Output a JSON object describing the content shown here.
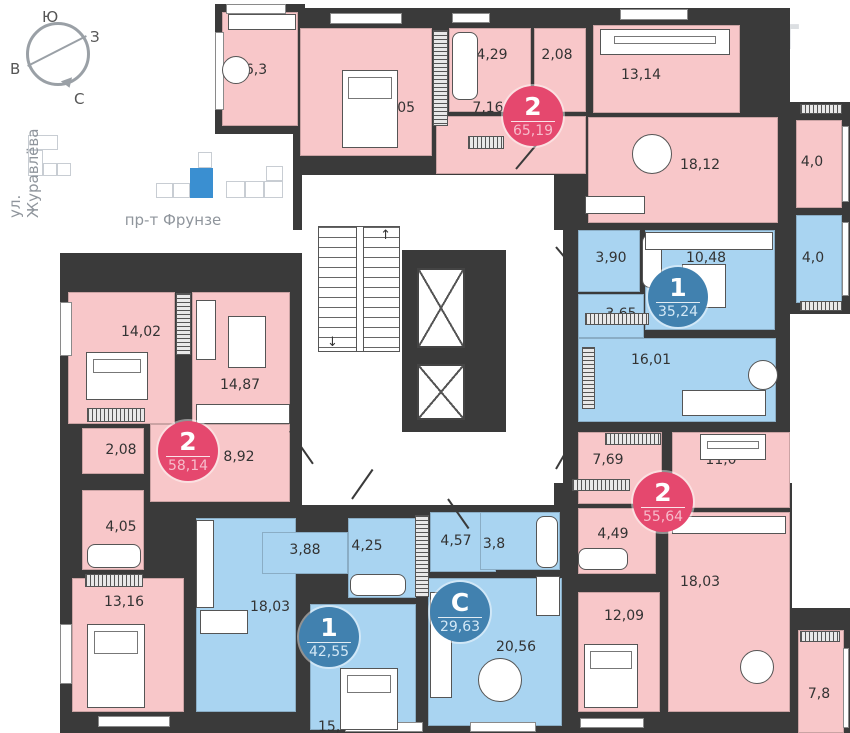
{
  "colors": {
    "wall": "#3a3a3a",
    "room_pink": "#f8c7c9",
    "room_blue": "#a9d4f1",
    "badge_red": "#e5486e",
    "badge_blue": "#4181af",
    "minimap_highlight": "#3a8fd1"
  },
  "compass": {
    "labels": [
      {
        "t": "Ю",
        "x": 42,
        "y": 8
      },
      {
        "t": "З",
        "x": 90,
        "y": 28
      },
      {
        "t": "В",
        "x": 10,
        "y": 60
      },
      {
        "t": "С",
        "x": 74,
        "y": 90
      }
    ]
  },
  "minimap": {
    "street_left": "ул. Журавлёва",
    "street_bottom": "пр-т Фрунзе",
    "origin": [
      20,
      130
    ],
    "blocks": [
      {
        "r": [
          8,
          5,
          30,
          15
        ]
      },
      {
        "r": [
          8,
          20,
          15,
          26
        ]
      },
      {
        "r": [
          23,
          33,
          14,
          13
        ]
      },
      {
        "r": [
          37,
          33,
          14,
          13
        ]
      },
      {
        "r": [
          136,
          53,
          17,
          15
        ]
      },
      {
        "r": [
          153,
          53,
          17,
          15
        ]
      },
      {
        "r": [
          170,
          38,
          23,
          30
        ],
        "hl": true
      },
      {
        "r": [
          178,
          22,
          14,
          16
        ]
      },
      {
        "r": [
          206,
          51,
          19,
          17
        ]
      },
      {
        "r": [
          225,
          51,
          19,
          17
        ]
      },
      {
        "r": [
          244,
          51,
          19,
          17
        ]
      },
      {
        "r": [
          246,
          36,
          17,
          15
        ]
      }
    ]
  },
  "watermark": {
    "line1": "ОНРЕАЛТ",
    "line2": "НЕДВИЖИМОСТЬ"
  },
  "plan": {
    "zones": [
      [
        215,
        4,
        90,
        130
      ],
      [
        293,
        8,
        497,
        222
      ],
      [
        788,
        102,
        62,
        212
      ],
      [
        563,
        222,
        227,
        273
      ],
      [
        60,
        253,
        245,
        480
      ],
      [
        178,
        483,
        614,
        250
      ],
      [
        790,
        608,
        60,
        125
      ]
    ],
    "corridor": {
      "rect": [
        302,
        175,
        252,
        330
      ],
      "stairs": [
        318,
        226,
        82,
        126
      ],
      "lift_block": [
        402,
        250,
        104,
        182
      ],
      "lifts": [
        [
          417,
          268,
          48,
          80
        ],
        [
          417,
          364,
          48,
          56
        ]
      ],
      "arrow_up": "↑",
      "arrow_down": "↓"
    },
    "extra_walls": [
      [
        295,
        560,
        16,
        152
      ],
      [
        416,
        578,
        16,
        152
      ]
    ],
    "rooms": [
      {
        "id": "balcony-6-3",
        "label": "6,3",
        "r": [
          222,
          12,
          76,
          114
        ],
        "c": "pink",
        "l": [
          256,
          70
        ]
      },
      {
        "id": "bedroom-16-05",
        "label": "16,05",
        "r": [
          300,
          28,
          132,
          128
        ],
        "c": "pink",
        "l": [
          395,
          108
        ]
      },
      {
        "id": "bath-4-29",
        "label": "4,29",
        "r": [
          449,
          28,
          82,
          84
        ],
        "c": "pink",
        "l": [
          492,
          55
        ]
      },
      {
        "id": "wc-2-08",
        "label": "2,08",
        "r": [
          534,
          28,
          52,
          84
        ],
        "c": "pink",
        "l": [
          557,
          55
        ]
      },
      {
        "id": "hall-7-16",
        "label": "7,16",
        "r": [
          436,
          116,
          150,
          58
        ],
        "c": "pink",
        "l": [
          488,
          108
        ]
      },
      {
        "id": "bedroom-13-14",
        "label": "13,14",
        "r": [
          593,
          25,
          147,
          88
        ],
        "c": "pink",
        "l": [
          641,
          75
        ]
      },
      {
        "id": "living-18-12",
        "label": "18,12",
        "r": [
          588,
          117,
          190,
          106
        ],
        "c": "pink",
        "l": [
          700,
          165
        ]
      },
      {
        "id": "balcony-4-0-a",
        "label": "4,0",
        "r": [
          796,
          120,
          46,
          88
        ],
        "c": "pink",
        "l": [
          812,
          162
        ]
      },
      {
        "id": "balcony-4-0-b",
        "label": "4,0",
        "r": [
          796,
          215,
          46,
          88
        ],
        "c": "blue",
        "l": [
          813,
          258
        ]
      },
      {
        "id": "bath-3-90",
        "label": "3,90",
        "r": [
          578,
          230,
          62,
          62
        ],
        "c": "blue",
        "l": [
          611,
          258
        ]
      },
      {
        "id": "kitchen-10-48",
        "label": "10,48",
        "r": [
          645,
          230,
          130,
          100
        ],
        "c": "blue",
        "l": [
          706,
          258
        ]
      },
      {
        "id": "hall-3-65",
        "label": "3,65",
        "r": [
          578,
          294,
          66,
          44
        ],
        "c": "blue",
        "l": [
          621,
          314
        ]
      },
      {
        "id": "living-16-01",
        "label": "16,01",
        "r": [
          578,
          338,
          198,
          84
        ],
        "c": "blue",
        "l": [
          651,
          360
        ]
      },
      {
        "id": "bedroom-14-02",
        "label": "14,02",
        "r": [
          68,
          292,
          107,
          132
        ],
        "c": "pink",
        "l": [
          141,
          332
        ]
      },
      {
        "id": "living-14-87",
        "label": "14,87",
        "r": [
          192,
          292,
          98,
          134
        ],
        "c": "pink",
        "l": [
          240,
          385
        ]
      },
      {
        "id": "wc-2-08-b",
        "label": "2,08",
        "r": [
          82,
          428,
          62,
          46
        ],
        "c": "pink",
        "l": [
          121,
          450
        ]
      },
      {
        "id": "hall-8-92",
        "label": "8,92",
        "r": [
          150,
          424,
          140,
          78
        ],
        "c": "pink",
        "l": [
          239,
          457
        ]
      },
      {
        "id": "bath-4-05",
        "label": "4,05",
        "r": [
          82,
          490,
          62,
          80
        ],
        "c": "pink",
        "l": [
          121,
          527
        ]
      },
      {
        "id": "bedroom-13-16",
        "label": "13,16",
        "r": [
          72,
          578,
          112,
          134
        ],
        "c": "pink",
        "l": [
          124,
          602
        ]
      },
      {
        "id": "kitchen-18-03-a",
        "label": "18,03",
        "r": [
          196,
          518,
          100,
          194
        ],
        "c": "blue",
        "l": [
          270,
          607
        ]
      },
      {
        "id": "hall-3-88",
        "label": "3,88",
        "r": [
          262,
          532,
          86,
          42
        ],
        "c": "blue",
        "l": [
          305,
          550
        ]
      },
      {
        "id": "bath-4-25",
        "label": "4,25",
        "r": [
          348,
          518,
          68,
          80
        ],
        "c": "blue",
        "l": [
          367,
          546
        ]
      },
      {
        "id": "bedroom-15-49",
        "label": "15,49",
        "r": [
          310,
          604,
          106,
          126
        ],
        "c": "blue",
        "l": [
          338,
          727
        ]
      },
      {
        "id": "hall-4-57",
        "label": "4,57",
        "r": [
          430,
          512,
          66,
          60
        ],
        "c": "blue",
        "l": [
          456,
          541
        ]
      },
      {
        "id": "bath-3-8",
        "label": "3,8",
        "r": [
          480,
          512,
          80,
          58
        ],
        "c": "blue",
        "l": [
          494,
          544
        ]
      },
      {
        "id": "studio-20-56",
        "label": "20,56",
        "r": [
          428,
          578,
          134,
          148
        ],
        "c": "blue",
        "l": [
          516,
          647
        ]
      },
      {
        "id": "hall-7-69",
        "label": "7,69",
        "r": [
          578,
          432,
          84,
          72
        ],
        "c": "pink",
        "l": [
          608,
          460
        ]
      },
      {
        "id": "bedroom-11-0",
        "label": "11,0",
        "r": [
          672,
          432,
          118,
          76
        ],
        "c": "pink",
        "l": [
          721,
          460
        ]
      },
      {
        "id": "bath-4-49",
        "label": "4,49",
        "r": [
          578,
          508,
          78,
          66
        ],
        "c": "pink",
        "l": [
          613,
          534
        ]
      },
      {
        "id": "bedroom-12-09",
        "label": "12,09",
        "r": [
          578,
          592,
          82,
          120
        ],
        "c": "pink",
        "l": [
          624,
          616
        ]
      },
      {
        "id": "kitchen-18-03-b",
        "label": "18,03",
        "r": [
          668,
          512,
          122,
          200
        ],
        "c": "pink",
        "l": [
          700,
          582
        ]
      },
      {
        "id": "balcony-7-8",
        "label": "7,8",
        "r": [
          798,
          630,
          46,
          103
        ],
        "c": "pink",
        "l": [
          819,
          694
        ]
      }
    ],
    "badges": [
      {
        "id": "apt-2-65",
        "num": "2",
        "area": "65,19",
        "c": "red",
        "p": [
          533,
          116
        ]
      },
      {
        "id": "apt-1-35",
        "num": "1",
        "area": "35,24",
        "c": "blue",
        "p": [
          678,
          297
        ]
      },
      {
        "id": "apt-2-58",
        "num": "2",
        "area": "58,14",
        "c": "red",
        "p": [
          188,
          451
        ]
      },
      {
        "id": "apt-1-42",
        "num": "1",
        "area": "42,55",
        "c": "blue",
        "p": [
          329,
          637
        ]
      },
      {
        "id": "apt-s-29",
        "num": "С",
        "area": "29,63",
        "c": "blue",
        "p": [
          460,
          612
        ]
      },
      {
        "id": "apt-2-55",
        "num": "2",
        "area": "55,64",
        "c": "red",
        "p": [
          663,
          502
        ]
      }
    ],
    "windows": [
      [
        226,
        4,
        60,
        10
      ],
      [
        330,
        13,
        72,
        11
      ],
      [
        452,
        13,
        38,
        10
      ],
      [
        620,
        9,
        68,
        11
      ],
      [
        60,
        302,
        12,
        54
      ],
      [
        60,
        624,
        12,
        60
      ],
      [
        98,
        716,
        72,
        11
      ],
      [
        345,
        722,
        78,
        10
      ],
      [
        470,
        722,
        66,
        10
      ],
      [
        580,
        718,
        64,
        10
      ],
      [
        215,
        32,
        9,
        78
      ],
      [
        842,
        126,
        7,
        76
      ],
      [
        842,
        222,
        7,
        74
      ],
      [
        843,
        648,
        6,
        80
      ]
    ],
    "hatches": [
      {
        "r": [
          433,
          30,
          15,
          96
        ],
        "d": "v"
      },
      {
        "r": [
          176,
          293,
          15,
          62
        ],
        "d": "v"
      },
      {
        "r": [
          87,
          408,
          58,
          14
        ],
        "d": "h"
      },
      {
        "r": [
          85,
          574,
          58,
          13
        ],
        "d": "h"
      },
      {
        "r": [
          415,
          515,
          14,
          82
        ],
        "d": "v"
      },
      {
        "r": [
          585,
          313,
          64,
          12
        ],
        "d": "h"
      },
      {
        "r": [
          582,
          347,
          13,
          62
        ],
        "d": "v"
      },
      {
        "r": [
          605,
          433,
          56,
          12
        ],
        "d": "h"
      },
      {
        "r": [
          572,
          479,
          58,
          12
        ],
        "d": "h"
      },
      {
        "r": [
          800,
          631,
          40,
          11
        ],
        "d": "h"
      },
      {
        "r": [
          800,
          104,
          42,
          10
        ],
        "d": "h"
      },
      {
        "r": [
          800,
          301,
          42,
          10
        ],
        "d": "h"
      },
      {
        "r": [
          468,
          136,
          36,
          13
        ],
        "d": "h"
      }
    ],
    "furniture": [
      {
        "t": "bed",
        "r": [
          342,
          70,
          56,
          78
        ]
      },
      {
        "t": "bed",
        "r": [
          86,
          352,
          62,
          48
        ]
      },
      {
        "t": "bed",
        "r": [
          87,
          624,
          58,
          84
        ]
      },
      {
        "t": "bed",
        "r": [
          340,
          668,
          58,
          62
        ]
      },
      {
        "t": "bed",
        "r": [
          584,
          644,
          54,
          64
        ]
      },
      {
        "t": "bed",
        "r": [
          700,
          434,
          66,
          26
        ]
      },
      {
        "t": "bed",
        "r": [
          600,
          29,
          130,
          26
        ]
      },
      {
        "t": "tub",
        "r": [
          452,
          32,
          26,
          68
        ]
      },
      {
        "t": "tub",
        "r": [
          87,
          544,
          54,
          24
        ]
      },
      {
        "t": "tub",
        "r": [
          350,
          574,
          56,
          22
        ]
      },
      {
        "t": "tub",
        "r": [
          536,
          516,
          22,
          52
        ]
      },
      {
        "t": "tub",
        "r": [
          642,
          234,
          20,
          54
        ]
      },
      {
        "t": "tub",
        "r": [
          578,
          548,
          50,
          22
        ]
      },
      {
        "t": "circle",
        "r": [
          632,
          134,
          40,
          40
        ]
      },
      {
        "t": "circle",
        "r": [
          478,
          658,
          44,
          44
        ]
      },
      {
        "t": "circle",
        "r": [
          740,
          650,
          34,
          34
        ]
      },
      {
        "t": "circle",
        "r": [
          748,
          360,
          30,
          30
        ]
      },
      {
        "t": "circle",
        "r": [
          222,
          56,
          28,
          28
        ]
      },
      {
        "t": "rect",
        "r": [
          228,
          316,
          38,
          52
        ]
      },
      {
        "t": "rect",
        "r": [
          200,
          610,
          48,
          24
        ]
      },
      {
        "t": "rect",
        "r": [
          682,
          264,
          44,
          44
        ]
      },
      {
        "t": "rect",
        "r": [
          645,
          232,
          128,
          18
        ]
      },
      {
        "t": "rect",
        "r": [
          196,
          404,
          94,
          20
        ]
      },
      {
        "t": "rect",
        "r": [
          196,
          520,
          18,
          88
        ]
      },
      {
        "t": "rect",
        "r": [
          672,
          516,
          114,
          18
        ]
      },
      {
        "t": "rect",
        "r": [
          585,
          196,
          60,
          18
        ]
      },
      {
        "t": "rect",
        "r": [
          228,
          14,
          68,
          16
        ]
      },
      {
        "t": "rect",
        "r": [
          536,
          576,
          24,
          40
        ]
      },
      {
        "t": "rect",
        "r": [
          682,
          390,
          84,
          26
        ]
      },
      {
        "t": "rect",
        "r": [
          196,
          300,
          20,
          60
        ]
      },
      {
        "t": "rect",
        "r": [
          430,
          592,
          22,
          106
        ]
      }
    ],
    "doors": [
      {
        "x": 290,
        "y": 430,
        "len": 40,
        "rot": 55
      },
      {
        "x": 352,
        "y": 498,
        "len": 36,
        "rot": -55
      },
      {
        "x": 448,
        "y": 498,
        "len": 36,
        "rot": 55
      },
      {
        "x": 556,
        "y": 468,
        "len": 36,
        "rot": -60
      },
      {
        "x": 556,
        "y": 246,
        "len": 32,
        "rot": 50
      },
      {
        "x": 516,
        "y": 168,
        "len": 34,
        "rot": -50
      }
    ]
  }
}
